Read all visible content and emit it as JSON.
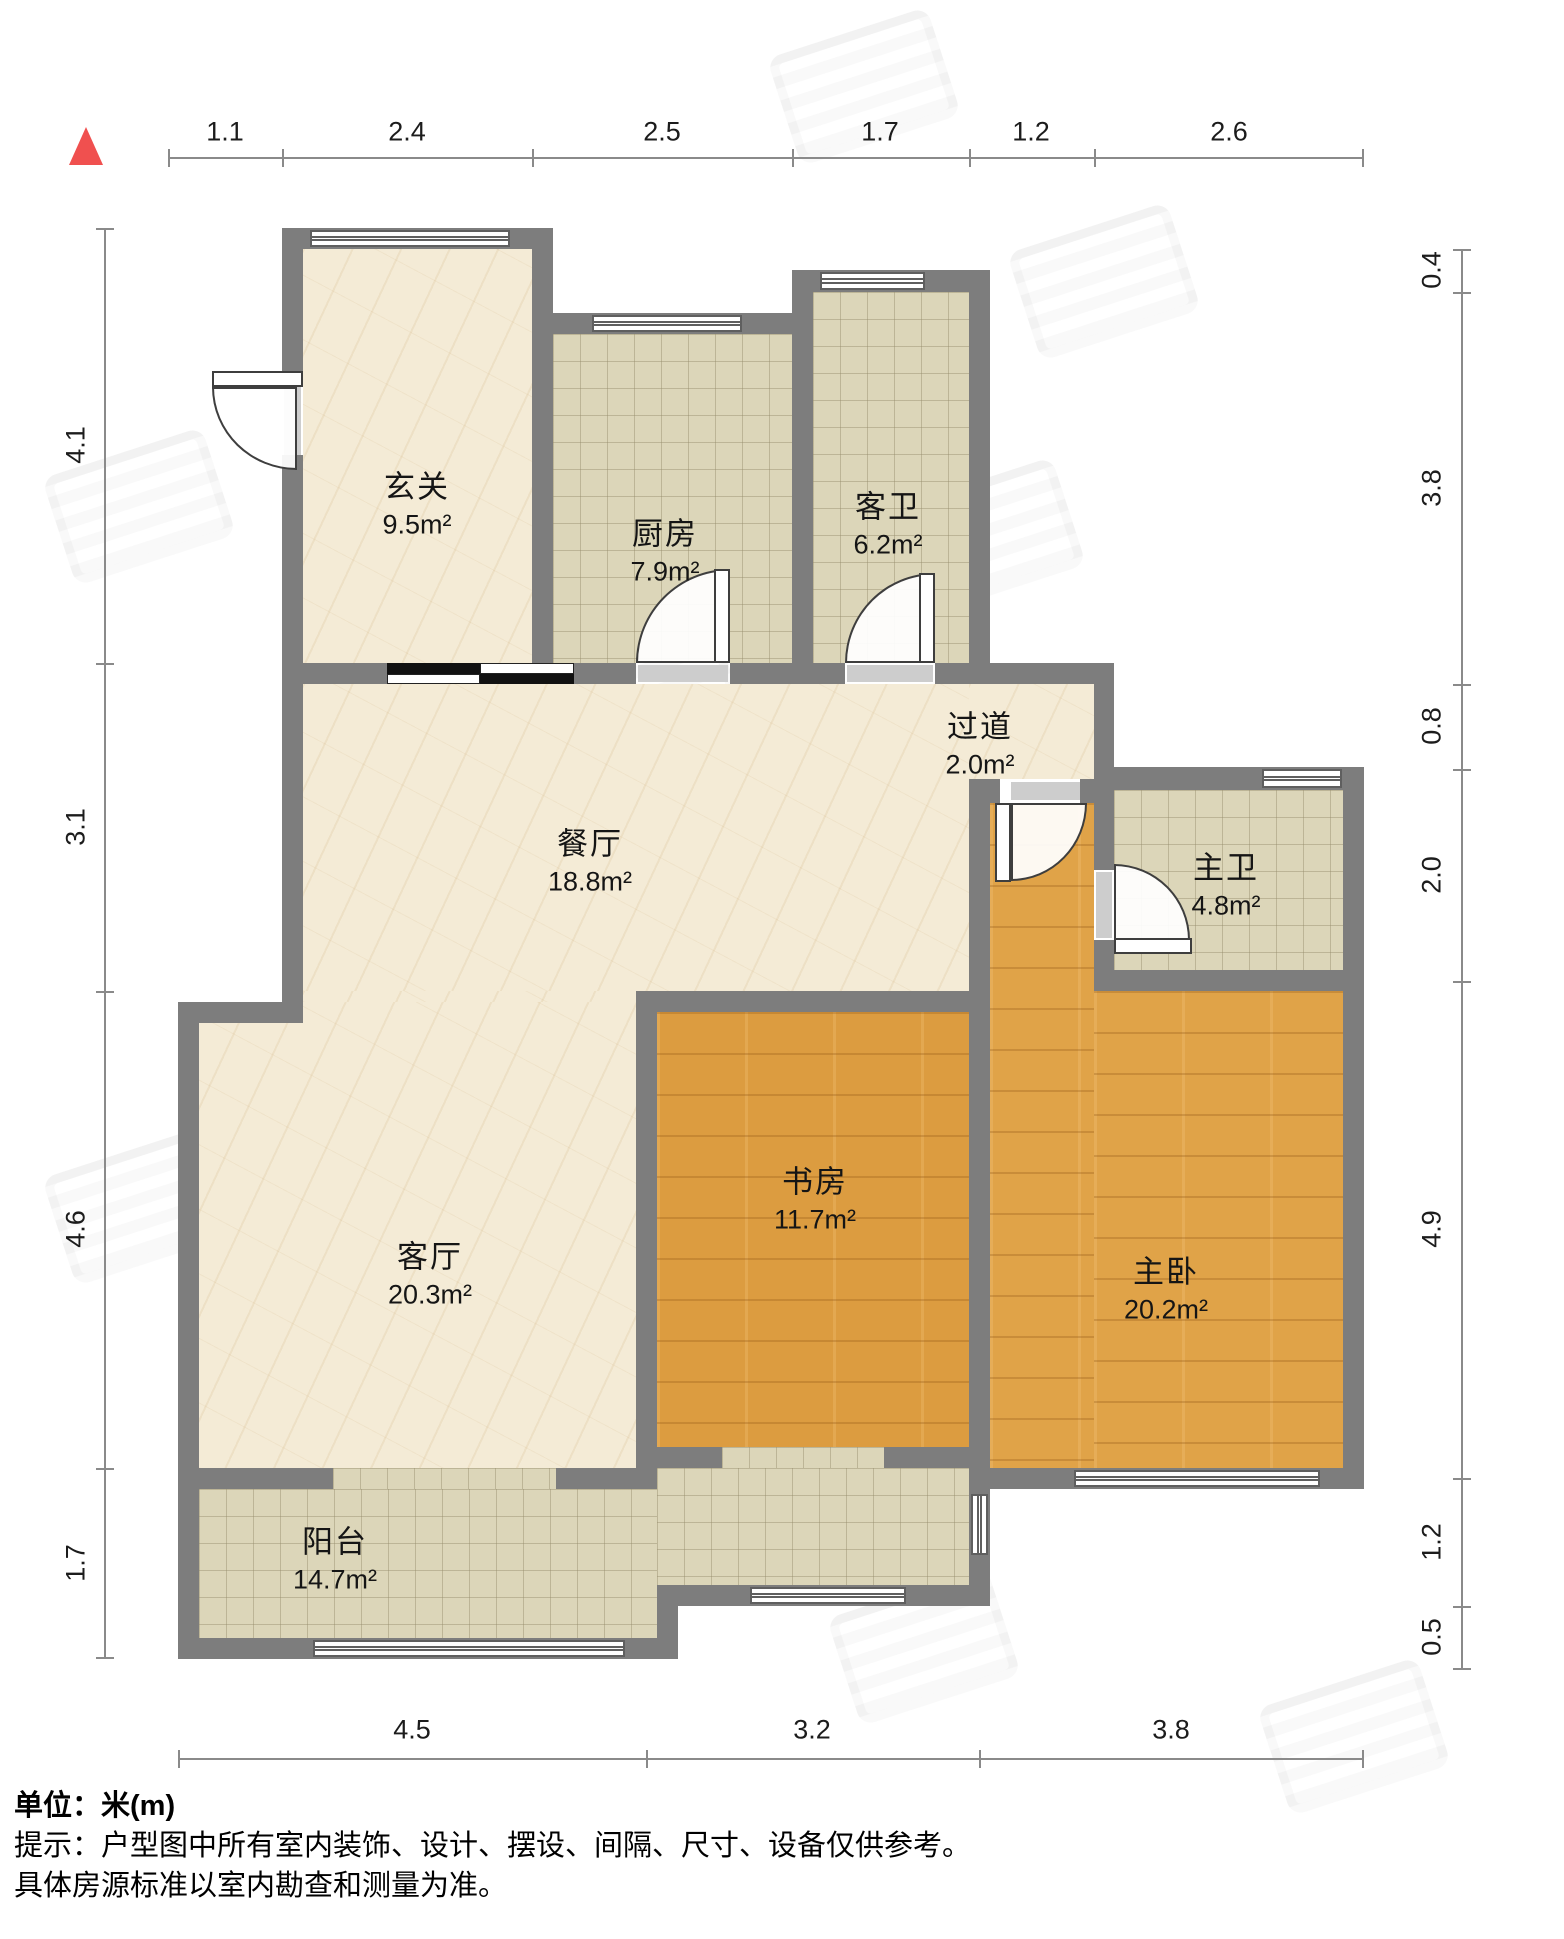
{
  "rooms": {
    "entrance": {
      "name": "玄关",
      "area": "9.5m²"
    },
    "kitchen": {
      "name": "厨房",
      "area": "7.9m²"
    },
    "guest_bath": {
      "name": "客卫",
      "area": "6.2m²"
    },
    "hallway": {
      "name": "过道",
      "area": "2.0m²"
    },
    "dining": {
      "name": "餐厅",
      "area": "18.8m²"
    },
    "master_bath": {
      "name": "主卫",
      "area": "4.8m²"
    },
    "living": {
      "name": "客厅",
      "area": "20.3m²"
    },
    "study": {
      "name": "书房",
      "area": "11.7m²"
    },
    "master_bedroom": {
      "name": "主卧",
      "area": "20.2m²"
    },
    "balcony": {
      "name": "阳台",
      "area": "14.7m²"
    }
  },
  "dimensions": {
    "top": [
      "1.1",
      "2.4",
      "2.5",
      "1.7",
      "1.2",
      "2.6"
    ],
    "bottom": [
      "4.5",
      "3.2",
      "3.8"
    ],
    "left": [
      "4.1",
      "3.1",
      "4.6",
      "1.7"
    ],
    "right": [
      "0.4",
      "3.8",
      "0.8",
      "2.0",
      "4.9",
      "1.2",
      "0.5"
    ]
  },
  "footer": {
    "unit": "单位：米(m)",
    "hint1": "提示：户型图中所有室内装饰、设计、摆设、间隔、尺寸、设备仅供参考。",
    "hint2": "具体房源标准以室内勘查和测量为准。"
  },
  "colors": {
    "wall": "#7d7d7d",
    "marble": "#f4ebd6",
    "tile": "#dcd6b9",
    "wood": "#dc9c40",
    "north_arrow": "#f0504f"
  }
}
